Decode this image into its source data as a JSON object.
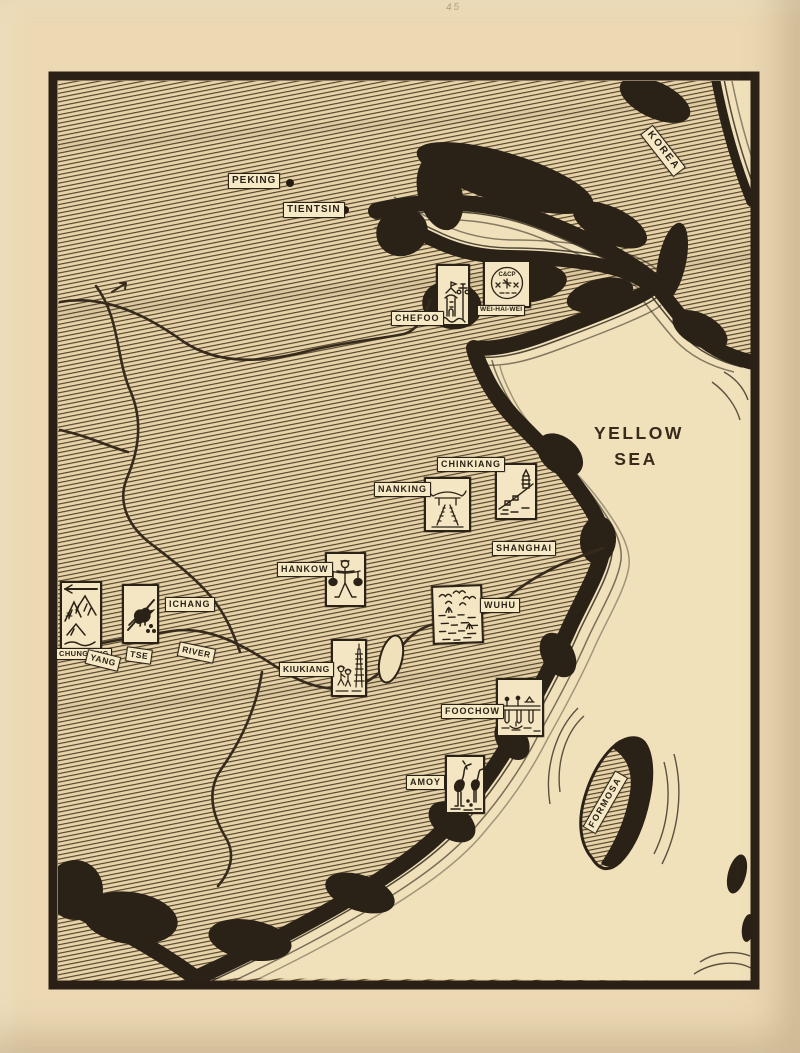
{
  "page": {
    "pencil_note": "45"
  },
  "colors": {
    "paper": "#ecd9b3",
    "sea": "#f0e1bb",
    "land_base": "#e7d3a8",
    "ink": "#2b2217",
    "label_bg": "#f6e9c6"
  },
  "sea_label": {
    "line1": "YELLOW",
    "line2": "SEA"
  },
  "regions": {
    "korea": "KOREA",
    "formosa": "FORMOSA"
  },
  "cities": [
    {
      "id": "peking",
      "label": "PEKING"
    },
    {
      "id": "tientsin",
      "label": "TIENTSIN"
    },
    {
      "id": "chefoo",
      "label": "CHEFOO"
    },
    {
      "id": "wei-hai-wei",
      "label": "WEI-HAI-WEI"
    },
    {
      "id": "chinkiang",
      "label": "CHINKIANG"
    },
    {
      "id": "nanking",
      "label": "NANKING"
    },
    {
      "id": "shanghai",
      "label": "SHANGHAI"
    },
    {
      "id": "hankow",
      "label": "HANKOW"
    },
    {
      "id": "wuhu",
      "label": "WUHU"
    },
    {
      "id": "ichang",
      "label": "ICHANG"
    },
    {
      "id": "chungking",
      "label": "CHUNGKING"
    },
    {
      "id": "kiukiang",
      "label": "KIUKIANG"
    },
    {
      "id": "foochow",
      "label": "FOOCHOW"
    },
    {
      "id": "amoy",
      "label": "AMOY"
    }
  ],
  "river_label": {
    "word1": "YANG",
    "word2": "TSE",
    "word3": "RIVER"
  },
  "stamp_texts": {
    "weihaiwei_seal": "C&CP"
  }
}
